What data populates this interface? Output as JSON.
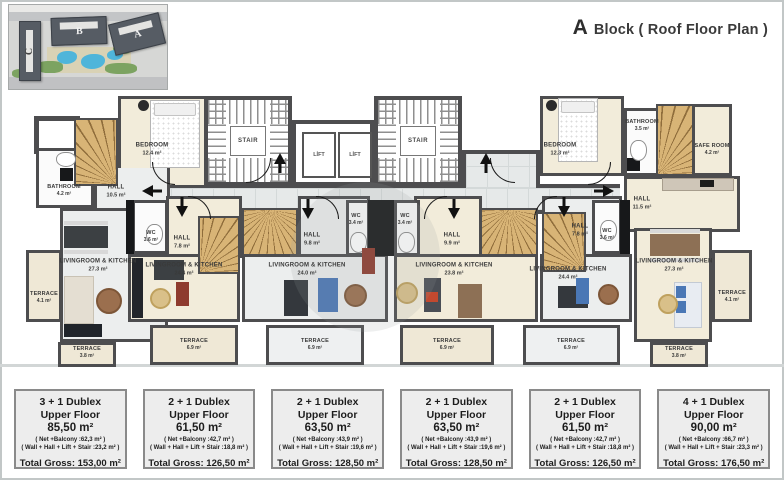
{
  "header": {
    "block_letter": "A",
    "title_rest": "Block ( Roof Floor Plan )"
  },
  "site_plan": {
    "building_a": "A",
    "building_b": "B",
    "building_c": "C"
  },
  "cores": {
    "stair": "STAIR",
    "lift": "LİFT"
  },
  "rooms": {
    "u1_bedroom": {
      "name": "BEDROOM",
      "area": "12.4 m²"
    },
    "u1_bathroom": {
      "name": "BATHROOM",
      "area": "4.2 m²"
    },
    "u1_hall": {
      "name": "HALL",
      "area": "10.5 m²"
    },
    "u1_living": {
      "name": "LIVINGROOM & KITCHEN",
      "area": "27.3 m²"
    },
    "u1_terrace_side": {
      "name": "TERRACE",
      "area": "4.1 m²"
    },
    "u1_terrace_bottom": {
      "name": "TERRACE",
      "area": "3.8 m²"
    },
    "u2_wc": {
      "name": "WC",
      "area": "3.6 m²"
    },
    "u2_hall": {
      "name": "HALL",
      "area": "7.8 m²"
    },
    "u2_living": {
      "name": "LIVINGROOM & KITCHEN",
      "area": "24.4 m²"
    },
    "u2_terrace": {
      "name": "TERRACE",
      "area": "6.9 m²"
    },
    "u3_wc": {
      "name": "WC",
      "area": "3.4 m²"
    },
    "u3_hall": {
      "name": "HALL",
      "area": "9.8 m²"
    },
    "u3_living": {
      "name": "LIVINGROOM & KITCHEN",
      "area": "24.0 m²"
    },
    "u3_terrace": {
      "name": "TERRACE",
      "area": "6.9 m²"
    },
    "u4_wc": {
      "name": "WC",
      "area": "3.4 m²"
    },
    "u4_hall": {
      "name": "HALL",
      "area": "9.9 m²"
    },
    "u4_living": {
      "name": "LIVINGROOM & KITCHEN",
      "area": "23.8 m²"
    },
    "u4_terrace": {
      "name": "TERRACE",
      "area": "6.9 m²"
    },
    "u5_wc": {
      "name": "WC",
      "area": "3.6 m²"
    },
    "u5_hall": {
      "name": "HALL",
      "area": "7.8 m²"
    },
    "u5_living": {
      "name": "LIVINGROOM & KITCHEN",
      "area": "24.4 m²"
    },
    "u5_terrace": {
      "name": "TERRACE",
      "area": "6.9 m²"
    },
    "u6_bedroom": {
      "name": "BEDROOM",
      "area": "12.3 m²"
    },
    "u6_bathroom": {
      "name": "BATHROOM",
      "area": "3.5 m²"
    },
    "u6_safe": {
      "name": "SAFE ROOM",
      "area": "4.2 m²"
    },
    "u6_hall": {
      "name": "HALL",
      "area": "11.5 m²"
    },
    "u6_living": {
      "name": "LIVINGROOM & KITCHEN",
      "area": "27.3 m²"
    },
    "u6_terrace_side": {
      "name": "TERRACE",
      "area": "4.1 m²"
    },
    "u6_terrace_bottom": {
      "name": "TERRACE",
      "area": "3.8 m²"
    }
  },
  "units": [
    {
      "title": "3 + 1 Dublex",
      "floor": "Upper Floor",
      "area": "85,50 m²",
      "net": "( Net +Balcony :62,3 m² )",
      "walls": "( Wall + Hall + Lift + Stair :23,2 m² )",
      "total": "Total Gross: 153,00 m²"
    },
    {
      "title": "2 + 1 Dublex",
      "floor": "Upper Floor",
      "area": "61,50 m²",
      "net": "( Net +Balcony :42,7 m² )",
      "walls": "( Wall + Hall + Lift + Stair :18,8 m² )",
      "total": "Total Gross: 126,50 m²"
    },
    {
      "title": "2 + 1 Dublex",
      "floor": "Upper Floor",
      "area": "63,50 m²",
      "net": "( Net +Balcony :43,9 m² )",
      "walls": "( Wall + Hall + Lift + Stair :19,6 m² )",
      "total": "Total Gross: 128,50 m²"
    },
    {
      "title": "2 + 1 Dublex",
      "floor": "Upper Floor",
      "area": "63,50 m²",
      "net": "( Net +Balcony :43,9 m² )",
      "walls": "( Wall + Hall + Lift + Stair :19,6 m² )",
      "total": "Total Gross: 128,50 m²"
    },
    {
      "title": "2 + 1 Dublex",
      "floor": "Upper Floor",
      "area": "61,50 m²",
      "net": "( Net +Balcony :42,7 m² )",
      "walls": "( Wall + Hall + Lift + Stair :18,8 m² )",
      "total": "Total Gross: 126,50 m²"
    },
    {
      "title": "4 + 1 Dublex",
      "floor": "Upper Floor",
      "area": "90,00 m²",
      "net": "( Net +Balcony :66,7 m² )",
      "walls": "( Wall + Hall + Lift + Stair :23,3 m² )",
      "total": "Total Gross: 176,50 m²"
    }
  ]
}
